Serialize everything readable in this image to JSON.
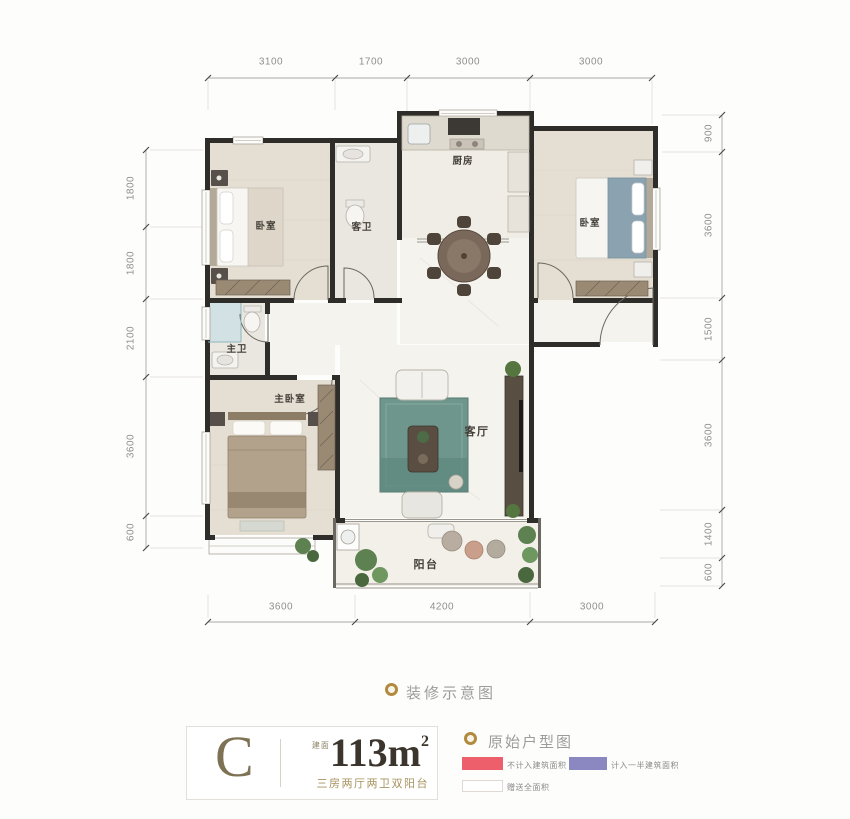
{
  "plan": {
    "dims": {
      "top": [
        "3100",
        "1700",
        "3000",
        "3000"
      ],
      "left": [
        "1800",
        "1800",
        "2100",
        "3600",
        "600"
      ],
      "right": [
        "900",
        "3600",
        "1500",
        "3600",
        "1400",
        "600"
      ],
      "bottom": [
        "3600",
        "4200",
        "3000"
      ]
    },
    "rooms": [
      {
        "name": "bedroom-left",
        "label": "卧室"
      },
      {
        "name": "guest-bath",
        "label": "客卫"
      },
      {
        "name": "kitchen",
        "label": "厨房"
      },
      {
        "name": "bedroom-right",
        "label": "卧室"
      },
      {
        "name": "master-bath",
        "label": "主卫"
      },
      {
        "name": "master-bedroom",
        "label": "主卧室"
      },
      {
        "name": "living-room",
        "label": "客厅"
      },
      {
        "name": "balcony",
        "label": "阳台"
      }
    ]
  },
  "caption": {
    "decor": "装修示意图"
  },
  "unit_card": {
    "letter": "C",
    "area_prefix": "建面",
    "area_number": "113m",
    "area_exp": "2",
    "subtitle": "三房两厅两卫双阳台"
  },
  "legend": {
    "title": "原始户型图",
    "items": [
      {
        "label": "不计入建筑面积",
        "color": "#ed5f6b"
      },
      {
        "label": "计入一半建筑面积",
        "color": "#8b88c1"
      },
      {
        "label": "赠送全面积",
        "color": "#ffffff"
      }
    ]
  },
  "colors": {
    "accent_gold": "#b28a3e",
    "wall": "#2f2d2a",
    "dim_text": "#8f8f8f"
  }
}
